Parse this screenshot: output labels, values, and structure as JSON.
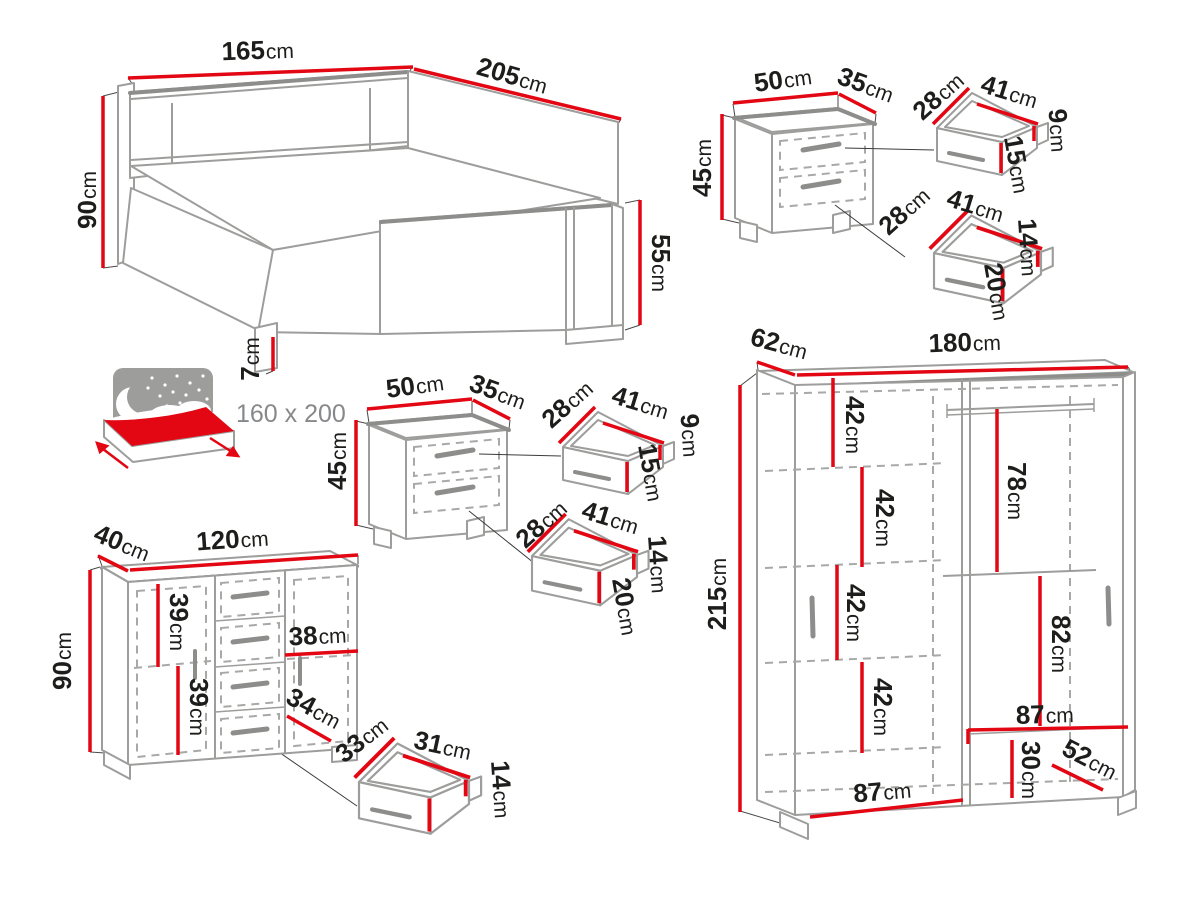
{
  "title": "Bedroom furniture set dimensions diagram",
  "units": "cm",
  "colors": {
    "dimension_red": "#e30613",
    "furniture_gray": "#9d9d9c",
    "text_black": "#1d1d1b",
    "background": "#ffffff"
  },
  "bed": {
    "width": {
      "v": "165",
      "u": "cm"
    },
    "length": {
      "v": "205",
      "u": "cm"
    },
    "headboard_height": {
      "v": "90",
      "u": "cm"
    },
    "footboard_height": {
      "v": "55",
      "u": "cm"
    },
    "leg_height": {
      "v": "7",
      "u": "cm"
    },
    "mattress_size": {
      "v": "160 x 200"
    }
  },
  "nightstand_right": {
    "width": {
      "v": "50",
      "u": "cm"
    },
    "depth": {
      "v": "35",
      "u": "cm"
    },
    "height": {
      "v": "45",
      "u": "cm"
    },
    "top_drawer": {
      "depth": {
        "v": "28",
        "u": "cm"
      },
      "width": {
        "v": "41",
        "u": "cm"
      },
      "side_height": {
        "v": "9",
        "u": "cm"
      },
      "front_height": {
        "v": "15",
        "u": "cm"
      }
    },
    "bottom_drawer": {
      "depth": {
        "v": "28",
        "u": "cm"
      },
      "width": {
        "v": "41",
        "u": "cm"
      },
      "side_height": {
        "v": "14",
        "u": "cm"
      },
      "front_height": {
        "v": "20",
        "u": "cm"
      }
    }
  },
  "nightstand_left": {
    "width": {
      "v": "50",
      "u": "cm"
    },
    "depth": {
      "v": "35",
      "u": "cm"
    },
    "height": {
      "v": "45",
      "u": "cm"
    },
    "top_drawer": {
      "depth": {
        "v": "28",
        "u": "cm"
      },
      "width": {
        "v": "41",
        "u": "cm"
      },
      "side_height": {
        "v": "9",
        "u": "cm"
      },
      "front_height": {
        "v": "15",
        "u": "cm"
      }
    },
    "bottom_drawer": {
      "depth": {
        "v": "28",
        "u": "cm"
      },
      "width": {
        "v": "41",
        "u": "cm"
      },
      "side_height": {
        "v": "14",
        "u": "cm"
      },
      "front_height": {
        "v": "20",
        "u": "cm"
      }
    }
  },
  "dresser": {
    "depth": {
      "v": "40",
      "u": "cm"
    },
    "width": {
      "v": "120",
      "u": "cm"
    },
    "height": {
      "v": "90",
      "u": "cm"
    },
    "shelf_spacing_top": {
      "v": "39",
      "u": "cm"
    },
    "shelf_spacing_bottom": {
      "v": "39",
      "u": "cm"
    },
    "door_inner_width": {
      "v": "38",
      "u": "cm"
    },
    "inner_depth": {
      "v": "34",
      "u": "cm"
    },
    "drawer": {
      "depth": {
        "v": "33",
        "u": "cm"
      },
      "width": {
        "v": "31",
        "u": "cm"
      },
      "front_height": {
        "v": "14",
        "u": "cm"
      }
    }
  },
  "wardrobe": {
    "depth": {
      "v": "62",
      "u": "cm"
    },
    "width": {
      "v": "180",
      "u": "cm"
    },
    "height": {
      "v": "215",
      "u": "cm"
    },
    "shelf_spacings": [
      {
        "v": "42",
        "u": "cm"
      },
      {
        "v": "42",
        "u": "cm"
      },
      {
        "v": "42",
        "u": "cm"
      },
      {
        "v": "42",
        "u": "cm"
      }
    ],
    "hanging_space_top": {
      "v": "78",
      "u": "cm"
    },
    "hanging_space_bottom": {
      "v": "82",
      "u": "cm"
    },
    "inner_width_top": {
      "v": "87",
      "u": "cm"
    },
    "bottom_shelf_height": {
      "v": "30",
      "u": "cm"
    },
    "bottom_shelf_depth": {
      "v": "52",
      "u": "cm"
    },
    "inner_width_bottom": {
      "v": "87",
      "u": "cm"
    }
  }
}
